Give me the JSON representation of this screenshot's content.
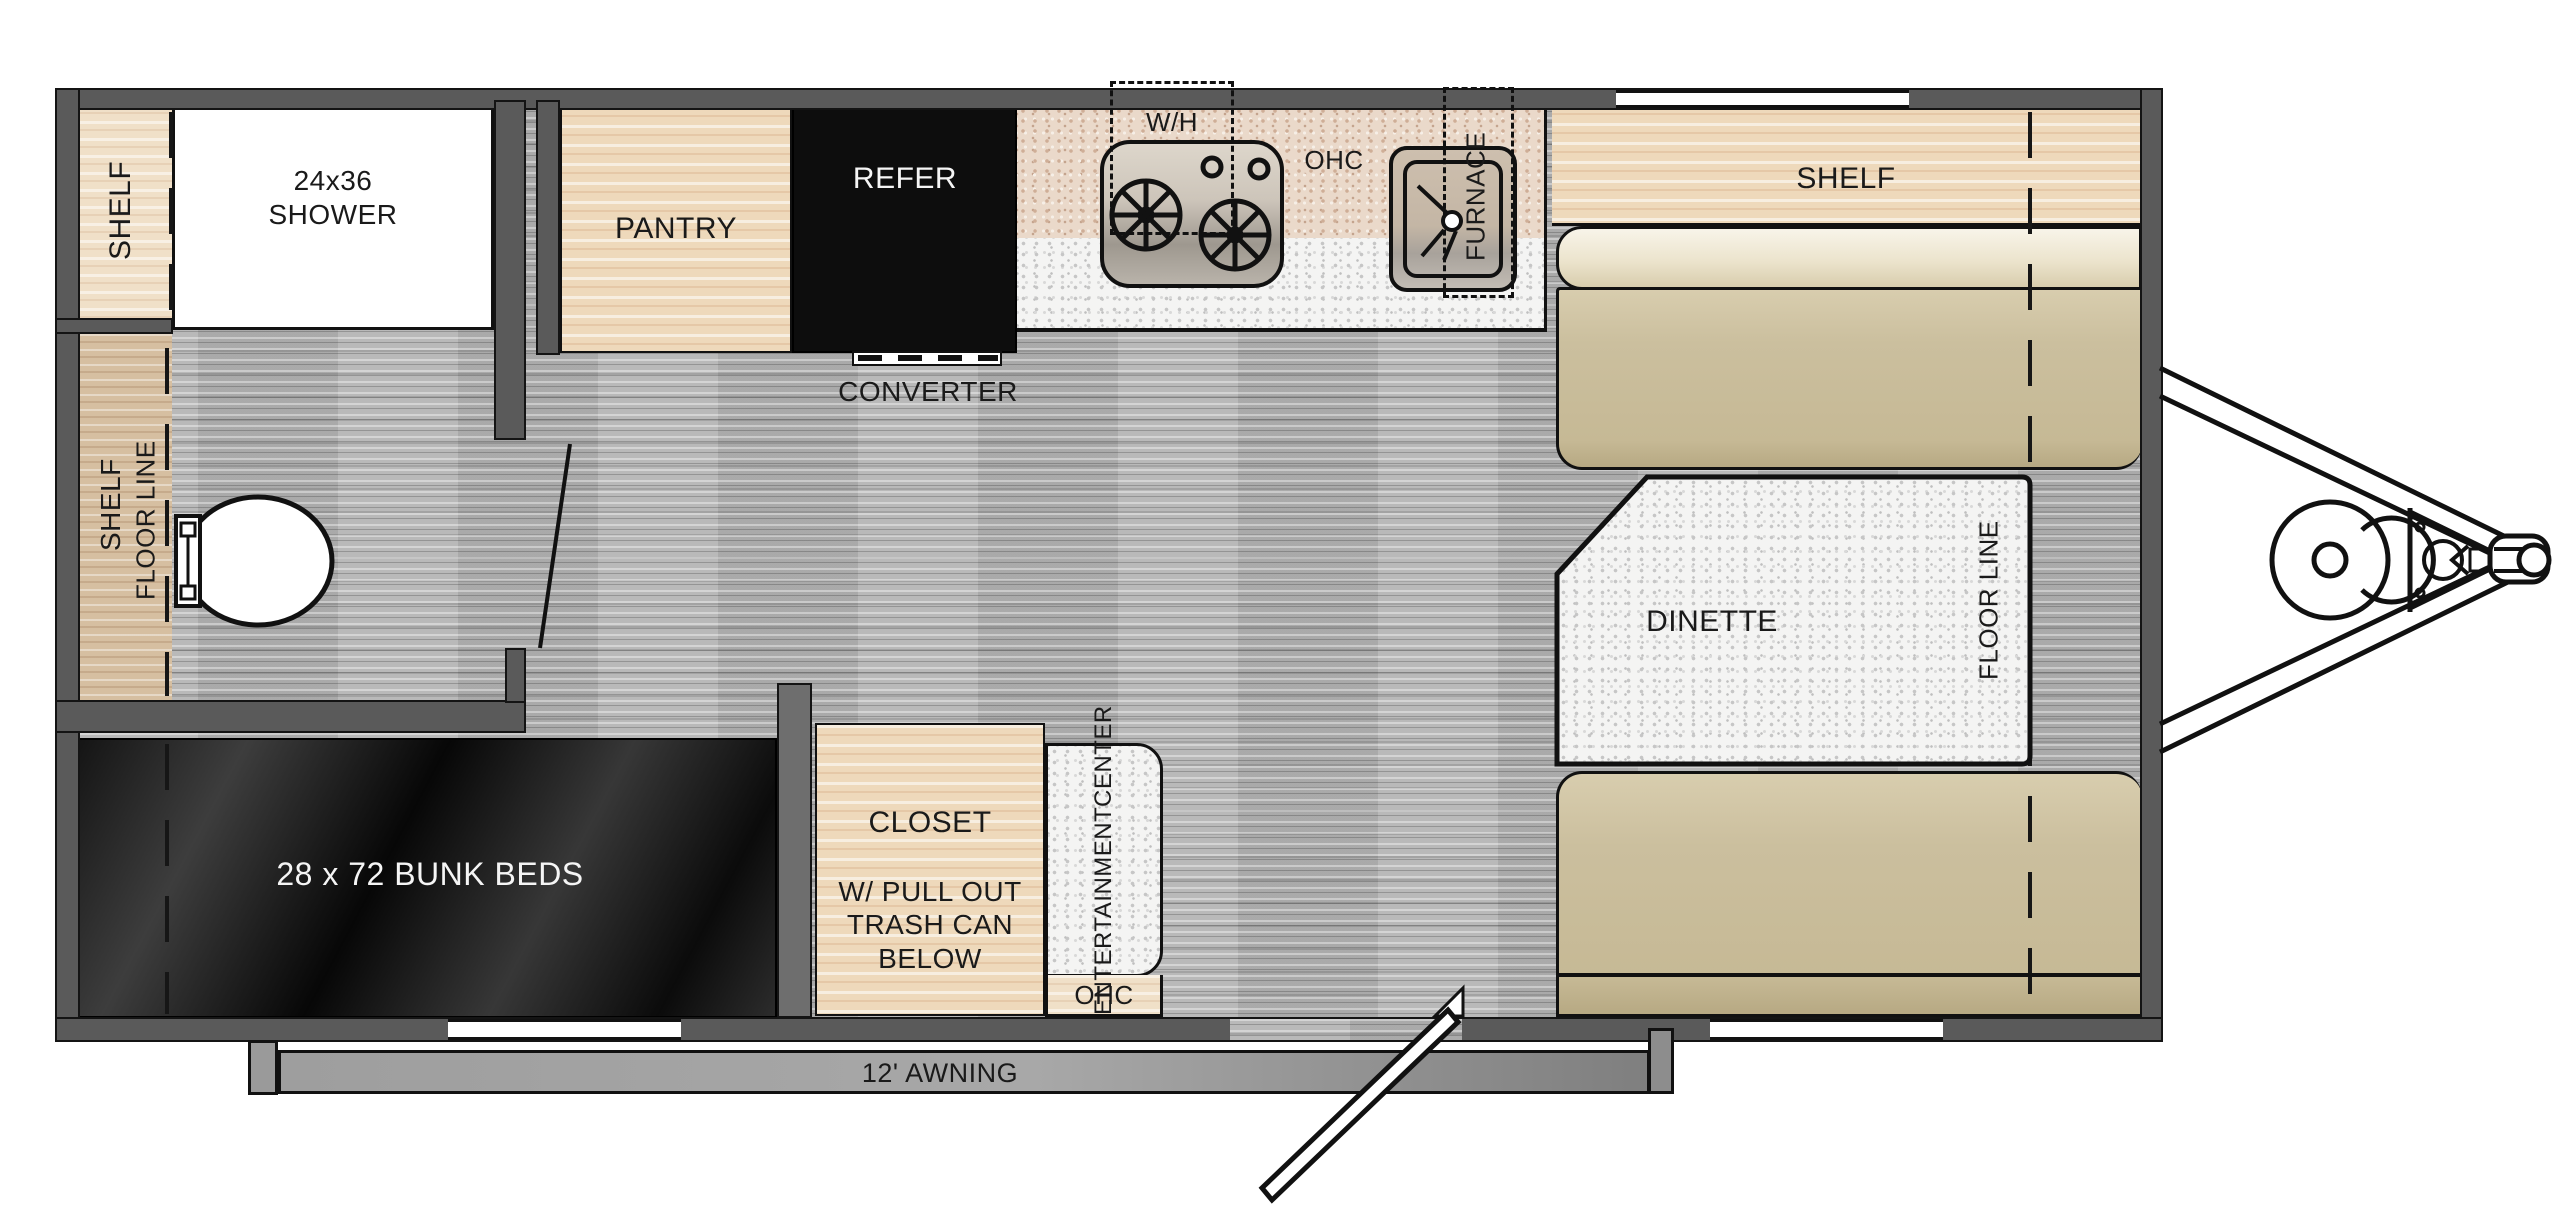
{
  "diagram": {
    "type": "rv-travel-trailer-floor-plan",
    "labels": {
      "shelf_top_left": "SHELF",
      "shower_line1": "24x36",
      "shower_line2": "SHOWER",
      "bath_shelf": "SHELF",
      "bath_floor_line": "FLOOR LINE",
      "pantry": "PANTRY",
      "refer": "REFER",
      "converter": "CONVERTER",
      "water_heater": "W/H",
      "kitchen_overhead_cabinet": "OHC",
      "furnace": "FURNACE",
      "front_shelf": "SHELF",
      "dinette": "DINETTE",
      "dinette_floor_line": "FLOOR LINE",
      "bunk_beds": "28 x 72 BUNK BEDS",
      "closet_line1": "CLOSET",
      "closet_line2": "W/ PULL OUT",
      "closet_line3": "TRASH CAN",
      "closet_line4": "BELOW",
      "entertainment_line1": "ENTERTAINMENT",
      "entertainment_line2": "CENTER",
      "entertainment_overhead_cabinet": "OHC",
      "awning": "12' AWNING"
    },
    "colors": {
      "wall_gray": "#5a5a5a",
      "floor_gray_wood": "#b4b4b4",
      "cabinet_wood_tan": "#eed9bb",
      "bath_wood_tan": "#d6bfa1",
      "cushion_khaki": "#c9bd9c",
      "counter_speckle_white": "#f4f4f3",
      "overhead_speckle_tan": "#ead9ca",
      "appliance_black": "#0d0d0d",
      "awning_gray": "#9a9a9a"
    }
  }
}
